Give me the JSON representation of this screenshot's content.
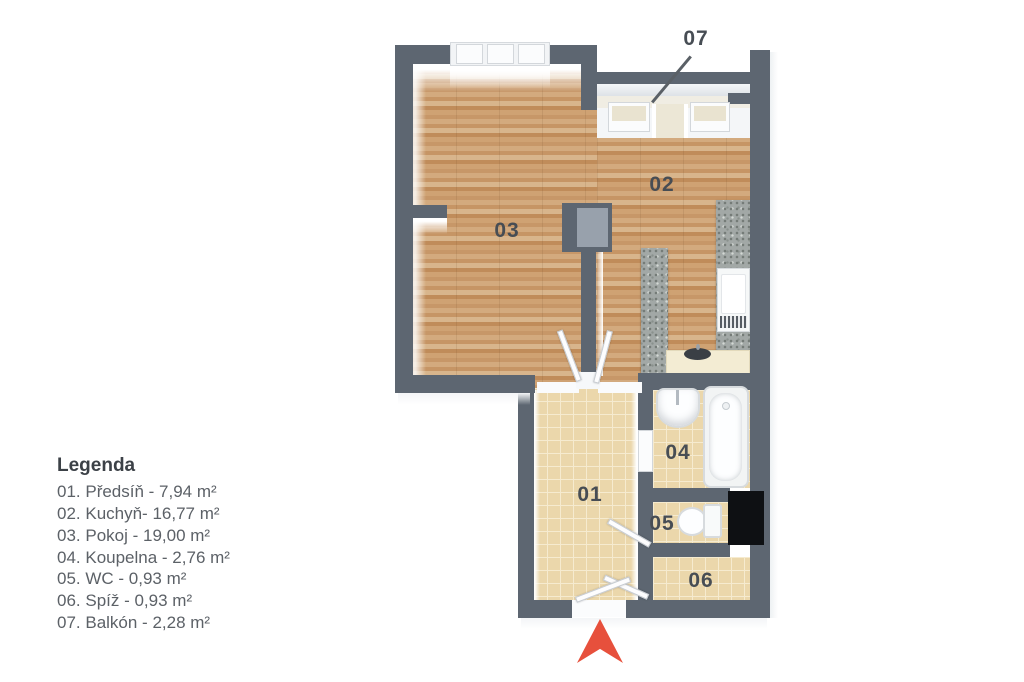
{
  "legend": {
    "title": "Legenda",
    "items": [
      "01. Předsíň - 7,94 m²",
      "02. Kuchyň- 16,77 m²",
      "03. Pokoj - 19,00 m²",
      "04. Koupelna - 2,76 m²",
      "05. WC - 0,93 m²",
      "06. Spíž - 0,93 m²",
      "07. Balkón - 2,28 m²"
    ]
  },
  "rooms": {
    "r01": {
      "label": "01",
      "name": "Předsíň",
      "area": "7,94 m²"
    },
    "r02": {
      "label": "02",
      "name": "Kuchyň",
      "area": "16,77 m²"
    },
    "r03": {
      "label": "03",
      "name": "Pokoj",
      "area": "19,00 m²"
    },
    "r04": {
      "label": "04",
      "name": "Koupelna",
      "area": "2,76 m²"
    },
    "r05": {
      "label": "05",
      "name": "WC",
      "area": "0,93 m²"
    },
    "r06": {
      "label": "06",
      "name": "Spíž",
      "area": "0,93 m²"
    },
    "r07": {
      "label": "07",
      "name": "Balkón",
      "area": "2,28 m²"
    }
  },
  "colors": {
    "wall": "#5d6671",
    "wall_inner": "#98a1ac",
    "wood": "#cda173",
    "tile": "#ebd7ab",
    "tile_grout": "#f6ebcf",
    "granite": "#a2a8a6",
    "counter": "#f3ecd3",
    "balcony_floor": "#f0ede3",
    "fixture_border": "#d7dbde",
    "shaft": "#0e1013",
    "arrow": "#e7503c",
    "label_text": "#474d54",
    "legend_text": "#5c6167",
    "legend_title": "#3c4147"
  }
}
